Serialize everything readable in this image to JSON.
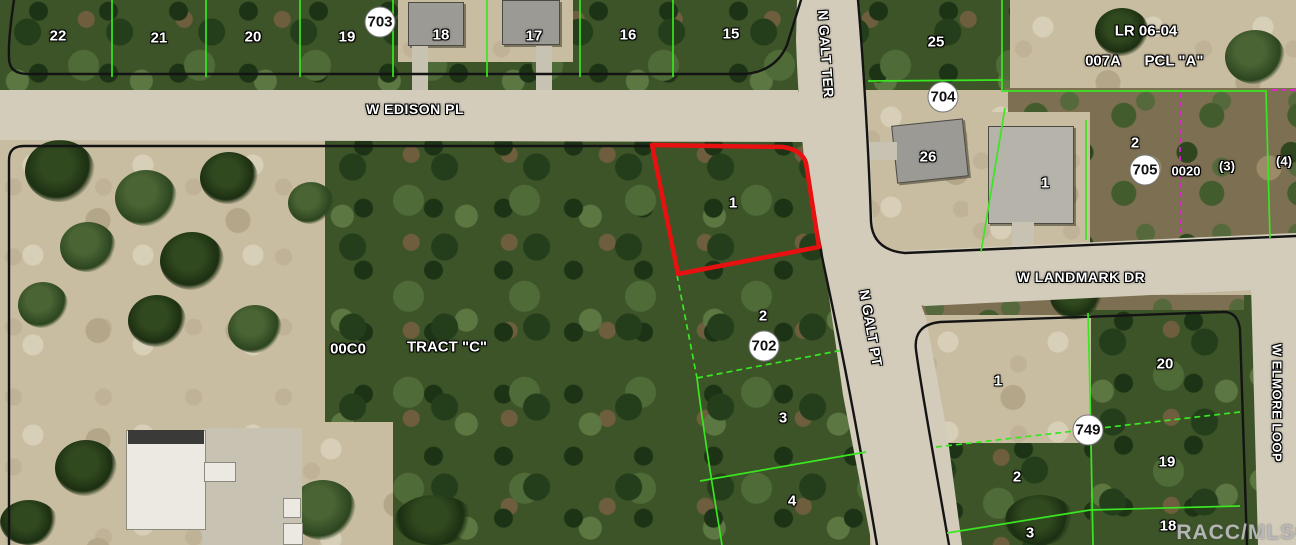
{
  "map_type": "aerial-parcel-map",
  "colors": {
    "parcel_line_green": "#3ae621",
    "highlight_red": "#e81111",
    "boundary_black": "#141414",
    "survey_magenta": "#e020ce",
    "road_surface": "#d3ccbb"
  },
  "streets": [
    {
      "id": "w-edison-pl",
      "label": "W EDISON PL"
    },
    {
      "id": "n-galt-ter",
      "label": "N GALT TER"
    },
    {
      "id": "n-galt-pt",
      "label": "N GALT PT"
    },
    {
      "id": "w-landmark-dr",
      "label": "W LANDMARK DR"
    },
    {
      "id": "w-elmore-loop",
      "label": "W ELMORE LOOP"
    }
  ],
  "block_circles": [
    {
      "id": "block-703",
      "label": "703"
    },
    {
      "id": "block-704",
      "label": "704"
    },
    {
      "id": "block-705",
      "label": "705"
    },
    {
      "id": "block-702",
      "label": "702"
    },
    {
      "id": "block-749",
      "label": "749"
    }
  ],
  "lot_labels": [
    {
      "id": "lot-22",
      "label": "22"
    },
    {
      "id": "lot-21",
      "label": "21"
    },
    {
      "id": "lot-20-top",
      "label": "20"
    },
    {
      "id": "lot-19-top",
      "label": "19"
    },
    {
      "id": "lot-18-top",
      "label": "18"
    },
    {
      "id": "lot-17",
      "label": "17"
    },
    {
      "id": "lot-16",
      "label": "16"
    },
    {
      "id": "lot-15",
      "label": "15"
    },
    {
      "id": "lot-25",
      "label": "25"
    },
    {
      "id": "lot-26",
      "label": "26"
    },
    {
      "id": "lot-1-highlight",
      "label": "1"
    },
    {
      "id": "lot-2-galt",
      "label": "2"
    },
    {
      "id": "lot-3-galt",
      "label": "3"
    },
    {
      "id": "lot-4-galt",
      "label": "4"
    },
    {
      "id": "lot-1-landmark",
      "label": "1"
    },
    {
      "id": "lot-2-705",
      "label": "2"
    },
    {
      "id": "lot-1-block",
      "label": "1"
    },
    {
      "id": "lot-20-block",
      "label": "20"
    },
    {
      "id": "lot-2-block",
      "label": "2"
    },
    {
      "id": "lot-19-block",
      "label": "19"
    },
    {
      "id": "lot-3-block",
      "label": "3"
    },
    {
      "id": "lot-18-block",
      "label": "18"
    }
  ],
  "annotations": [
    {
      "id": "lr-06-04",
      "label": "LR 06-04"
    },
    {
      "id": "pcl-007a",
      "label": "007A"
    },
    {
      "id": "pcl-a",
      "label": "PCL \"A\""
    },
    {
      "id": "pcl-0020",
      "label": "0020"
    },
    {
      "id": "paren-3",
      "label": "(3)"
    },
    {
      "id": "paren-4",
      "label": "(4)"
    },
    {
      "id": "pcl-00c0",
      "label": "00C0"
    },
    {
      "id": "tract-c",
      "label": "TRACT \"C\""
    }
  ],
  "watermark": "RACC/MLS©"
}
